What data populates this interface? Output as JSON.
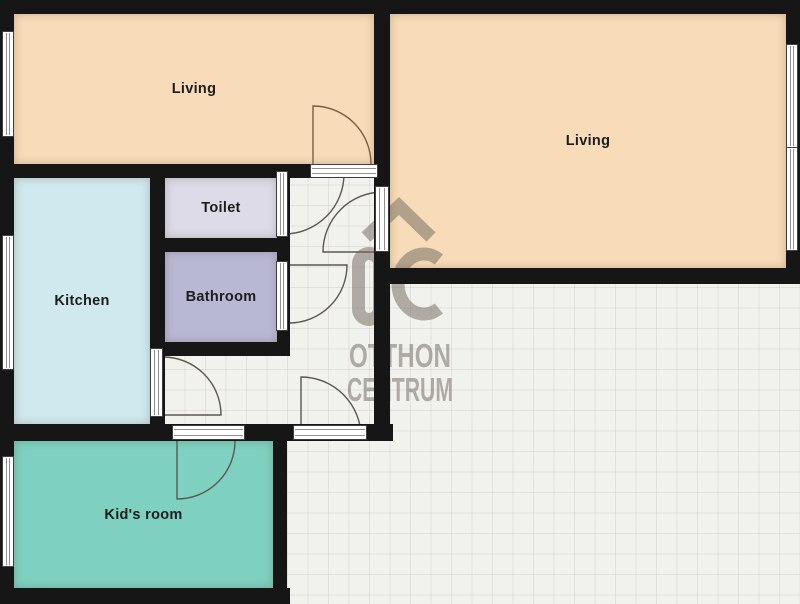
{
  "rooms": [
    {
      "id": "living-left",
      "label": "Living",
      "color": "#f8dcba"
    },
    {
      "id": "living-right",
      "label": "Living",
      "color": "#f8dcba"
    },
    {
      "id": "toilet",
      "label": "Toilet",
      "color": "#dcdbe7"
    },
    {
      "id": "bathroom",
      "label": "Bathroom",
      "color": "#b9b8d4"
    },
    {
      "id": "kitchen",
      "label": "Kitchen",
      "color": "#cfe9ee"
    },
    {
      "id": "kids-room",
      "label": "Kid's room",
      "color": "#7ed1c0"
    }
  ],
  "watermark": {
    "logo": "OC",
    "line1": "OTTHON",
    "line2": "CENTRUM",
    "color": "#6f675c"
  },
  "colors": {
    "wall": "#161616",
    "floor_background": "#f1f1ee",
    "grid_line": "#dcdcd7",
    "door_swing": "#5d574f",
    "door_swing_living": "#7d5c42",
    "window_fill": "#ffffff"
  }
}
